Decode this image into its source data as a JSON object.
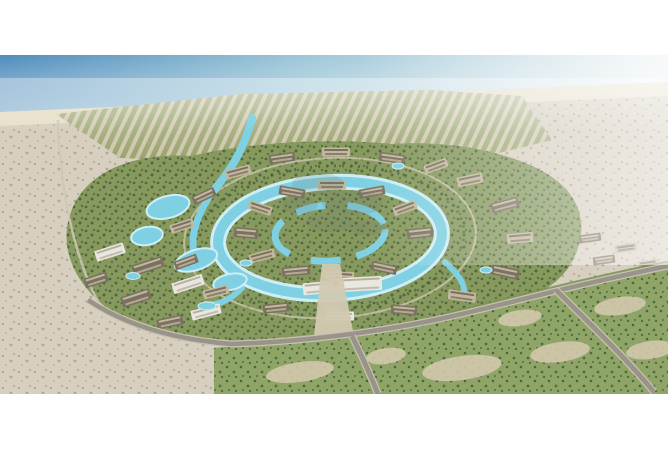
{
  "meta": {
    "description": "Aerial architectural rendering of a coastal master-planned resort community: sea and beach at top, grid of villa rows, central circular district ringed by a turquoise lagoon, apartment blocks with pools at lower left, desert surroundings, access roads and green fields at bottom. No visible text; a faint illegible watermark sits at center."
  },
  "palette": {
    "frame_white": "#ffffff",
    "sea_deep": "#4f8dbd",
    "sea_mid": "#9cc6d8",
    "sea_pale": "#ecf2f3",
    "beach": "#e6dfca",
    "desert": "#d7cfc0",
    "desert_dot": "#9a9175",
    "villa_row_tan": "#cdc4a8",
    "villa_row_green": "#98a36e",
    "dev_green": "#87995d",
    "tree_dark": "#44603c",
    "lagoon": "#7fd0e2",
    "lagoon_edge": "#cdeef4",
    "building_tan": "#c3b89c",
    "roof_dark": "#7a7163",
    "building_white": "#e9e7e0",
    "road": "#98948a",
    "road_edge": "#c9c2b0",
    "boulevard": "#d2c9b2",
    "field_green": "#8ea567",
    "field_dot": "#3f5632",
    "sand_patch": "#d2c8ac",
    "watermark": "#70797a"
  },
  "scene": {
    "lakes": [
      {
        "x": 168,
        "y": 207,
        "rx": 22,
        "ry": 11,
        "rot": -15
      },
      {
        "x": 147,
        "y": 236,
        "rx": 16,
        "ry": 9,
        "rot": -10
      },
      {
        "x": 196,
        "y": 260,
        "rx": 22,
        "ry": 10,
        "rot": -18
      },
      {
        "x": 230,
        "y": 282,
        "rx": 17,
        "ry": 8,
        "rot": -12
      }
    ],
    "clusters": [
      {
        "x": 420,
        "y": 233,
        "w": 26,
        "h": 10,
        "r": -6,
        "s": 1
      },
      {
        "x": 405,
        "y": 208,
        "w": 24,
        "h": 9,
        "r": -20,
        "s": 0
      },
      {
        "x": 372,
        "y": 192,
        "w": 26,
        "h": 9,
        "r": -10,
        "s": 1
      },
      {
        "x": 332,
        "y": 185,
        "w": 28,
        "h": 9,
        "r": 0,
        "s": 0
      },
      {
        "x": 292,
        "y": 192,
        "w": 26,
        "h": 9,
        "r": 10,
        "s": 1
      },
      {
        "x": 260,
        "y": 208,
        "w": 24,
        "h": 9,
        "r": 18,
        "s": 0
      },
      {
        "x": 246,
        "y": 233,
        "w": 24,
        "h": 10,
        "r": 5,
        "s": 1
      },
      {
        "x": 262,
        "y": 256,
        "w": 26,
        "h": 9,
        "r": -15,
        "s": 0
      },
      {
        "x": 296,
        "y": 271,
        "w": 28,
        "h": 9,
        "r": -5,
        "s": 1
      },
      {
        "x": 340,
        "y": 276,
        "w": 28,
        "h": 9,
        "r": 3,
        "s": 0
      },
      {
        "x": 384,
        "y": 268,
        "w": 26,
        "h": 9,
        "r": 12,
        "s": 1
      },
      {
        "x": 470,
        "y": 180,
        "w": 26,
        "h": 10,
        "r": -12,
        "s": 0
      },
      {
        "x": 505,
        "y": 205,
        "w": 28,
        "h": 10,
        "r": -15,
        "s": 1
      },
      {
        "x": 520,
        "y": 238,
        "w": 26,
        "h": 10,
        "r": -5,
        "s": 0
      },
      {
        "x": 505,
        "y": 272,
        "w": 28,
        "h": 10,
        "r": 12,
        "s": 1
      },
      {
        "x": 462,
        "y": 296,
        "w": 28,
        "h": 10,
        "r": 8,
        "s": 0
      },
      {
        "x": 404,
        "y": 310,
        "w": 26,
        "h": 9,
        "r": 5,
        "s": 1
      },
      {
        "x": 340,
        "y": 316,
        "w": 28,
        "h": 9,
        "r": 0,
        "s": 2
      },
      {
        "x": 276,
        "y": 308,
        "w": 26,
        "h": 9,
        "r": -6,
        "s": 1
      },
      {
        "x": 216,
        "y": 292,
        "w": 26,
        "h": 9,
        "r": -14,
        "s": 0
      },
      {
        "x": 186,
        "y": 262,
        "w": 24,
        "h": 9,
        "r": -20,
        "s": 1
      },
      {
        "x": 182,
        "y": 226,
        "w": 24,
        "h": 9,
        "r": -18,
        "s": 0
      },
      {
        "x": 204,
        "y": 196,
        "w": 24,
        "h": 9,
        "r": -25,
        "s": 1
      },
      {
        "x": 238,
        "y": 172,
        "w": 26,
        "h": 9,
        "r": -15,
        "s": 0
      },
      {
        "x": 282,
        "y": 158,
        "w": 26,
        "h": 9,
        "r": -8,
        "s": 1
      },
      {
        "x": 336,
        "y": 152,
        "w": 28,
        "h": 9,
        "r": 0,
        "s": 0
      },
      {
        "x": 392,
        "y": 158,
        "w": 26,
        "h": 9,
        "r": 8,
        "s": 1
      },
      {
        "x": 436,
        "y": 166,
        "w": 24,
        "h": 9,
        "r": -20,
        "s": 0
      },
      {
        "x": 110,
        "y": 252,
        "w": 30,
        "h": 11,
        "r": -18,
        "s": 2
      },
      {
        "x": 148,
        "y": 266,
        "w": 32,
        "h": 11,
        "r": -18,
        "s": 1
      },
      {
        "x": 188,
        "y": 284,
        "w": 32,
        "h": 11,
        "r": -18,
        "s": 2
      },
      {
        "x": 136,
        "y": 298,
        "w": 30,
        "h": 11,
        "r": -18,
        "s": 1
      },
      {
        "x": 206,
        "y": 312,
        "w": 30,
        "h": 10,
        "r": -15,
        "s": 2
      },
      {
        "x": 96,
        "y": 280,
        "w": 24,
        "h": 10,
        "r": -18,
        "s": 1
      },
      {
        "x": 170,
        "y": 322,
        "w": 26,
        "h": 10,
        "r": -12,
        "s": 1
      },
      {
        "x": 590,
        "y": 238,
        "w": 22,
        "h": 8,
        "r": -8,
        "s": 1
      },
      {
        "x": 626,
        "y": 248,
        "w": 22,
        "h": 8,
        "r": -8,
        "s": 0
      },
      {
        "x": 604,
        "y": 260,
        "w": 22,
        "h": 8,
        "r": -8,
        "s": 1
      },
      {
        "x": 648,
        "y": 264,
        "w": 20,
        "h": 8,
        "r": -8,
        "s": 0
      },
      {
        "x": 360,
        "y": 284,
        "w": 44,
        "h": 14,
        "r": -3,
        "s": 2
      },
      {
        "x": 318,
        "y": 288,
        "w": 30,
        "h": 12,
        "r": -5,
        "s": 2
      }
    ],
    "pools": [
      {
        "x": 133,
        "y": 276,
        "rx": 7,
        "ry": 3.5
      },
      {
        "x": 207,
        "y": 306,
        "rx": 9,
        "ry": 4
      },
      {
        "x": 246,
        "y": 263,
        "rx": 6,
        "ry": 3
      },
      {
        "x": 398,
        "y": 166,
        "rx": 6,
        "ry": 3
      },
      {
        "x": 486,
        "y": 270,
        "rx": 6,
        "ry": 3
      }
    ],
    "sand_patches": [
      {
        "x": 300,
        "y": 372,
        "rx": 34,
        "ry": 10
      },
      {
        "x": 462,
        "y": 368,
        "rx": 40,
        "ry": 12
      },
      {
        "x": 560,
        "y": 352,
        "rx": 30,
        "ry": 10
      },
      {
        "x": 620,
        "y": 306,
        "rx": 26,
        "ry": 9
      },
      {
        "x": 520,
        "y": 318,
        "rx": 22,
        "ry": 8
      },
      {
        "x": 386,
        "y": 356,
        "rx": 20,
        "ry": 8
      },
      {
        "x": 650,
        "y": 350,
        "rx": 24,
        "ry": 9
      }
    ],
    "watermark_blobs": [
      {
        "x": 318,
        "y": 184,
        "rx": 26,
        "ry": 11
      },
      {
        "x": 352,
        "y": 203,
        "rx": 30,
        "ry": 13
      },
      {
        "x": 330,
        "y": 222,
        "rx": 24,
        "ry": 10
      },
      {
        "x": 368,
        "y": 228,
        "rx": 18,
        "ry": 8
      },
      {
        "x": 300,
        "y": 205,
        "rx": 18,
        "ry": 9
      }
    ]
  }
}
